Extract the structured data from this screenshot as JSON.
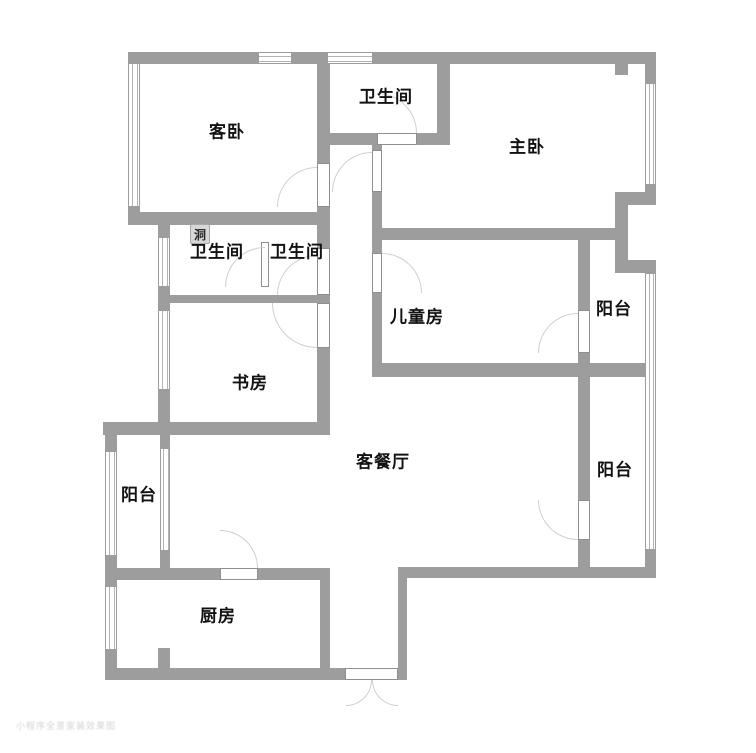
{
  "title": "apartment-floor-plan",
  "colors": {
    "wall": "#9d9d9d",
    "window_line": "#b3b3b3",
    "door_arc": "#cfcfcf",
    "text": "#121212",
    "annotation_bg": "#d7d7d7"
  },
  "rooms": {
    "guest_bedroom": {
      "label": "客卧"
    },
    "bathroom_top": {
      "label": "卫生间"
    },
    "master_bedroom": {
      "label": "主卧"
    },
    "bathroom_left": {
      "label": "卫生间"
    },
    "bathroom_right": {
      "label": "卫生间"
    },
    "children_room": {
      "label": "儿童房"
    },
    "balcony_right_upper": {
      "label": "阳台"
    },
    "balcony_right_lower": {
      "label": "阳台"
    },
    "study": {
      "label": "书房"
    },
    "living_dining": {
      "label": "客餐厅"
    },
    "balcony_left": {
      "label": "阳台"
    },
    "kitchen": {
      "label": "厨房"
    }
  },
  "annotations": {
    "hole_label": "洞"
  },
  "watermark": "小程序全景家装效果图"
}
